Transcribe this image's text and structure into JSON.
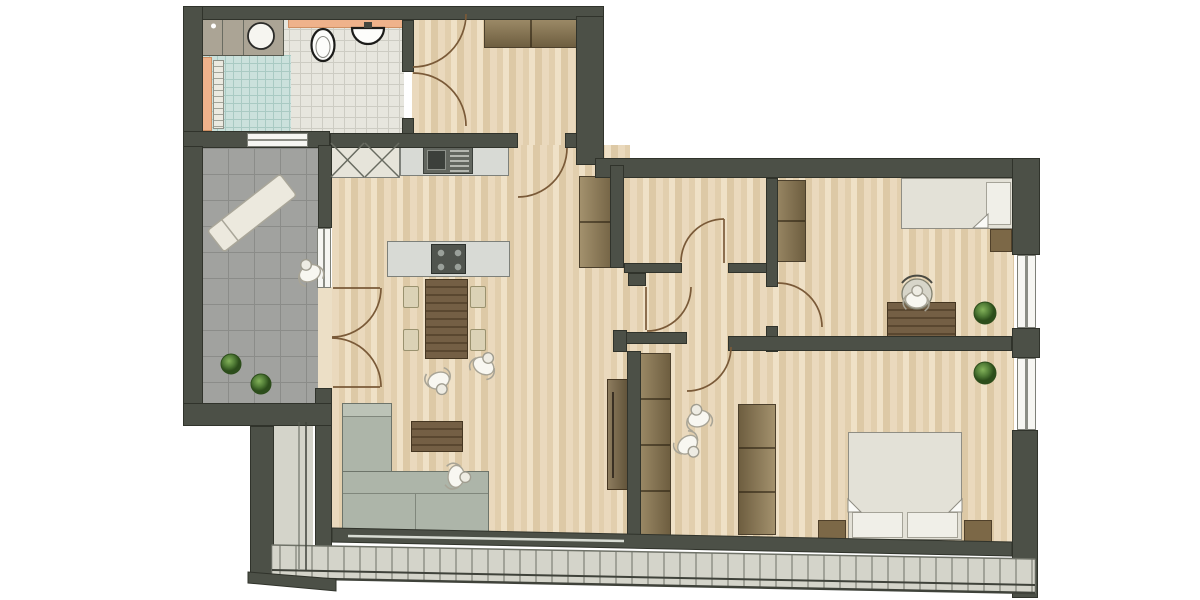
{
  "title": "apartment-floor-plan",
  "colors": {
    "wall": "#4c5047",
    "wall_edge": "#30332b",
    "wood_floor": "#e6d5b7",
    "terrace_tile": "#a1a29f",
    "shower_tile": "#cbe1dc",
    "bath_tile": "#e7e6de",
    "balcony_floor": "#d4d4ca",
    "accent_orange": "#efb28b",
    "window": "#f6f6f2",
    "sofa": "#adb5a9",
    "furniture_wood_dark": "#6b5539",
    "wardrobe_wood": "#8a7a58",
    "plant_green": "#4f7a35",
    "door_arc": "#7a5a38"
  },
  "inventory": {
    "rooms": [
      "bathroom",
      "entry-hall",
      "kitchen-living-dining",
      "terrace",
      "middle-room",
      "corridor",
      "bedroom-office",
      "bedroom-master",
      "walk-in-closet",
      "balcony"
    ],
    "fixtures": [
      "washer-counter",
      "round-basin",
      "toilet",
      "wall-sink",
      "shower",
      "kitchen-sink",
      "cooktop",
      "windows",
      "door-swings",
      "railing"
    ],
    "furniture": [
      "hall-wardrobe",
      "niche-wardrobe",
      "kitchen-island",
      "dining-table",
      "dining-chairs",
      "l-sofa",
      "coffee-table",
      "sideboard",
      "closet-wardrobes",
      "single-bed",
      "double-bed",
      "nightstands",
      "desk",
      "desk-chair",
      "sun-lounger"
    ]
  },
  "entities": {
    "plants": [
      {
        "x": 231,
        "y": 364,
        "r": 10
      },
      {
        "x": 261,
        "y": 384,
        "r": 10
      },
      {
        "x": 985,
        "y": 313,
        "r": 11
      },
      {
        "x": 985,
        "y": 373,
        "r": 11
      }
    ],
    "people": [
      {
        "x": 307,
        "y": 267,
        "rot": -25
      },
      {
        "x": 487,
        "y": 360,
        "rot": 30
      },
      {
        "x": 441,
        "y": 387,
        "rot": 160
      },
      {
        "x": 463,
        "y": 477,
        "rot": 95
      },
      {
        "x": 697,
        "y": 412,
        "rot": -15
      },
      {
        "x": 692,
        "y": 450,
        "rot": 140
      },
      {
        "x": 917,
        "y": 293,
        "rot": 5
      }
    ]
  }
}
